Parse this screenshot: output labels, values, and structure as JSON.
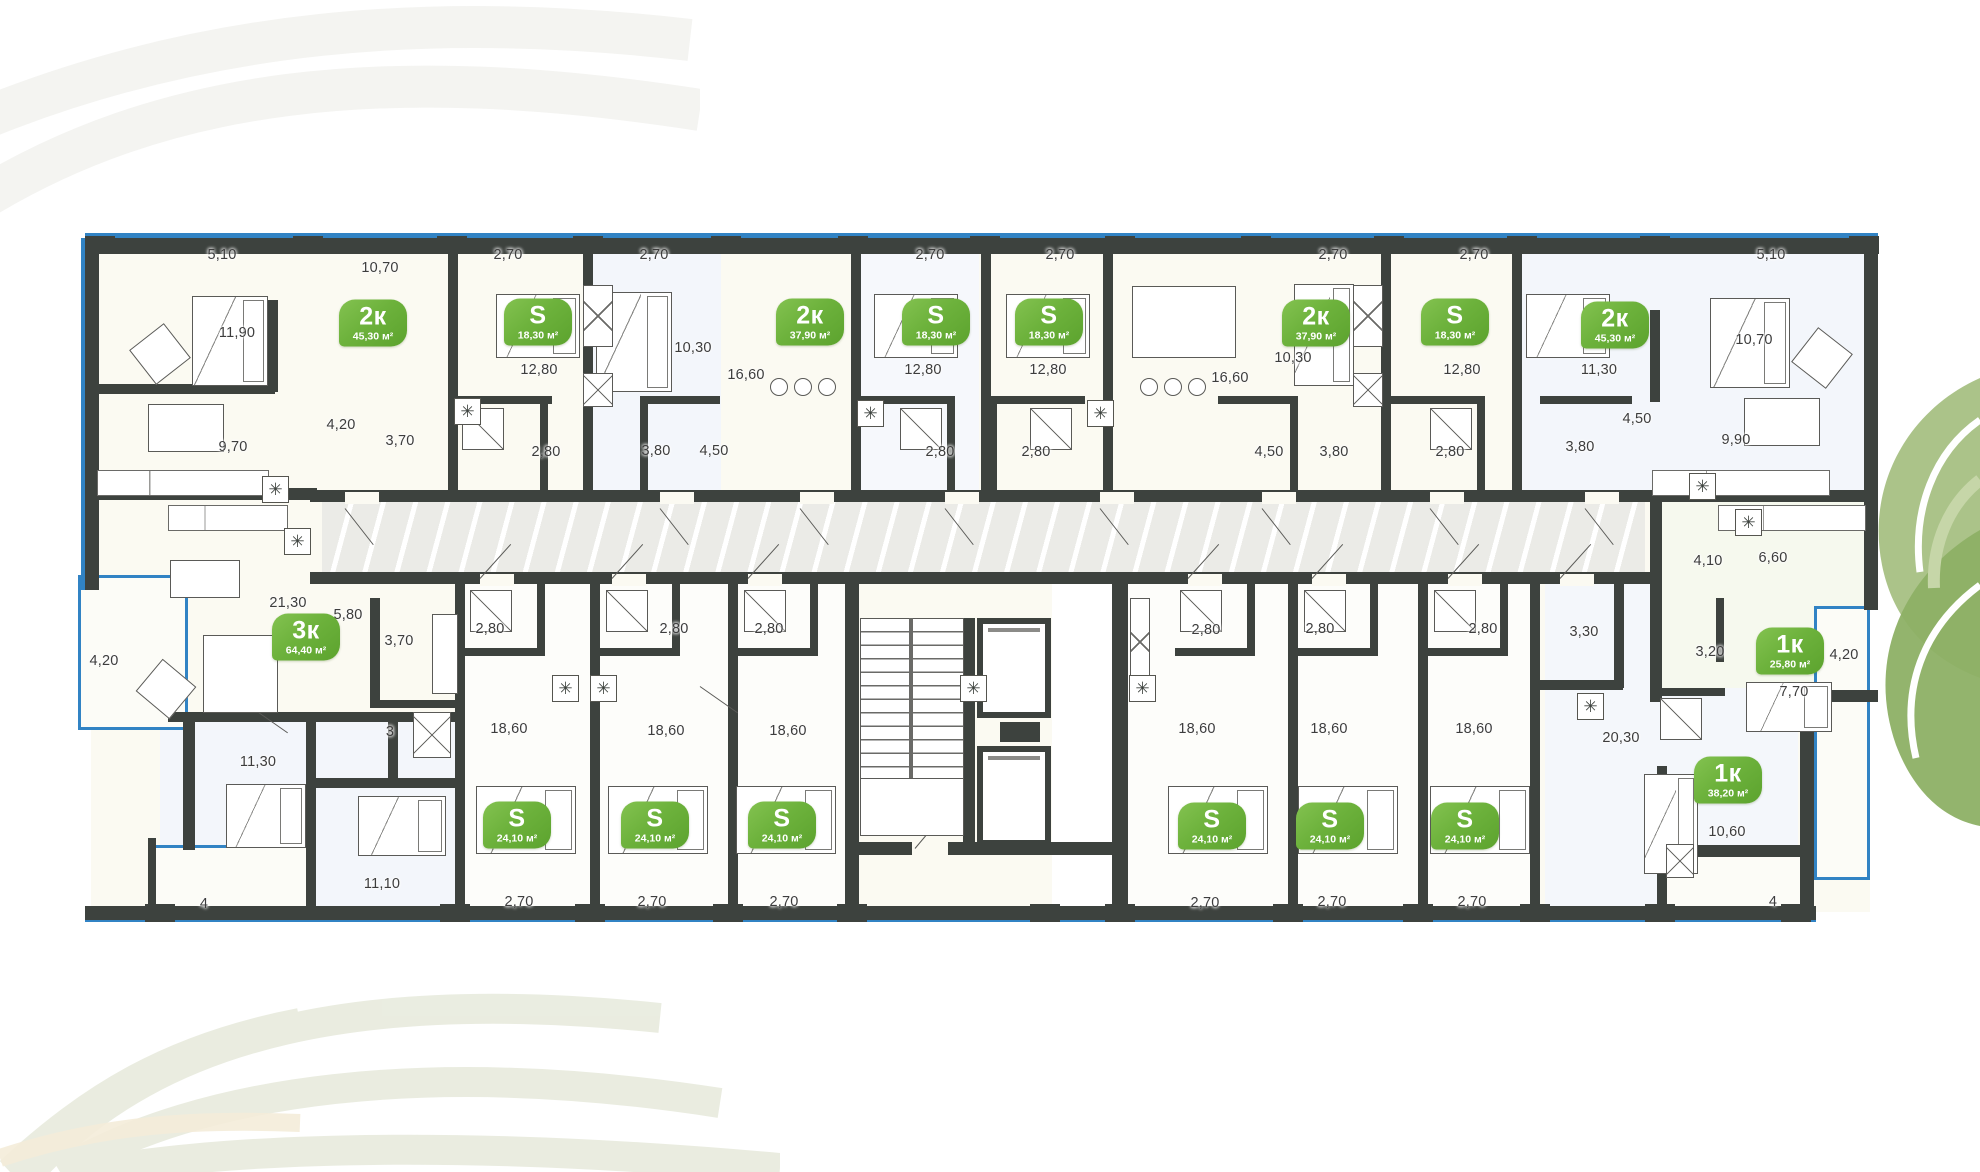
{
  "plan_meta": {
    "kind": "residential floor plan",
    "floor_badge_unit_types": [
      "1к",
      "2к",
      "3к",
      "S"
    ]
  },
  "palette": {
    "wall": "#3d423e",
    "window_blue": "#3183c4",
    "badge_green": "#6db23c",
    "badge_green_light": "#83c250",
    "badge_green_dark": "#5ca32e",
    "dim_text": "#3d3d3d",
    "corridor_fill": "#ebebe7"
  },
  "icons": {
    "appliance_icon_glyph": "✳"
  },
  "apartments": [
    {
      "type": "2к",
      "area": "45,30 м²",
      "x": 373,
      "y": 323
    },
    {
      "type": "S",
      "area": "18,30 м²",
      "x": 538,
      "y": 322
    },
    {
      "type": "2к",
      "area": "37,90 м²",
      "x": 810,
      "y": 322
    },
    {
      "type": "S",
      "area": "18,30 м²",
      "x": 936,
      "y": 322
    },
    {
      "type": "S",
      "area": "18,30 м²",
      "x": 1049,
      "y": 322
    },
    {
      "type": "2к",
      "area": "37,90 м²",
      "x": 1316,
      "y": 323
    },
    {
      "type": "S",
      "area": "18,30 м²",
      "x": 1455,
      "y": 322
    },
    {
      "type": "2к",
      "area": "45,30 м²",
      "x": 1615,
      "y": 325
    },
    {
      "type": "3к",
      "area": "64,40 м²",
      "x": 306,
      "y": 637
    },
    {
      "type": "S",
      "area": "24,10 м²",
      "x": 517,
      "y": 825
    },
    {
      "type": "S",
      "area": "24,10 м²",
      "x": 655,
      "y": 825
    },
    {
      "type": "S",
      "area": "24,10 м²",
      "x": 782,
      "y": 825
    },
    {
      "type": "S",
      "area": "24,10 м²",
      "x": 1212,
      "y": 826
    },
    {
      "type": "S",
      "area": "24,10 м²",
      "x": 1330,
      "y": 826
    },
    {
      "type": "S",
      "area": "24,10 м²",
      "x": 1465,
      "y": 826
    },
    {
      "type": "1к",
      "area": "25,80 м²",
      "x": 1790,
      "y": 651
    },
    {
      "type": "1к",
      "area": "38,20 м²",
      "x": 1728,
      "y": 780
    }
  ],
  "dimensions": [
    {
      "t": "5,10",
      "x": 222,
      "y": 255
    },
    {
      "t": "10,70",
      "x": 380,
      "y": 268
    },
    {
      "t": "11,90",
      "x": 237,
      "y": 333
    },
    {
      "t": "4,20",
      "x": 341,
      "y": 425
    },
    {
      "t": "3,70",
      "x": 400,
      "y": 441
    },
    {
      "t": "9,70",
      "x": 233,
      "y": 447
    },
    {
      "t": "2,70",
      "x": 508,
      "y": 255
    },
    {
      "t": "12,80",
      "x": 539,
      "y": 370
    },
    {
      "t": "2,80",
      "x": 546,
      "y": 452
    },
    {
      "t": "2,70",
      "x": 654,
      "y": 255
    },
    {
      "t": "10,30",
      "x": 693,
      "y": 348
    },
    {
      "t": "3,80",
      "x": 656,
      "y": 451
    },
    {
      "t": "4,50",
      "x": 714,
      "y": 451
    },
    {
      "t": "16,60",
      "x": 746,
      "y": 375
    },
    {
      "t": "2,70",
      "x": 930,
      "y": 255
    },
    {
      "t": "12,80",
      "x": 923,
      "y": 370
    },
    {
      "t": "2,80",
      "x": 940,
      "y": 452
    },
    {
      "t": "2,70",
      "x": 1060,
      "y": 255
    },
    {
      "t": "12,80",
      "x": 1048,
      "y": 370
    },
    {
      "t": "2,80",
      "x": 1036,
      "y": 452
    },
    {
      "t": "16,60",
      "x": 1230,
      "y": 378
    },
    {
      "t": "10,30",
      "x": 1293,
      "y": 358
    },
    {
      "t": "2,70",
      "x": 1333,
      "y": 255
    },
    {
      "t": "4,50",
      "x": 1269,
      "y": 452
    },
    {
      "t": "3,80",
      "x": 1334,
      "y": 452
    },
    {
      "t": "2,70",
      "x": 1474,
      "y": 255
    },
    {
      "t": "12,80",
      "x": 1462,
      "y": 370
    },
    {
      "t": "2,80",
      "x": 1450,
      "y": 452
    },
    {
      "t": "11,30",
      "x": 1599,
      "y": 370
    },
    {
      "t": "3,80",
      "x": 1580,
      "y": 447
    },
    {
      "t": "5,10",
      "x": 1771,
      "y": 255
    },
    {
      "t": "10,70",
      "x": 1754,
      "y": 340
    },
    {
      "t": "4,50",
      "x": 1637,
      "y": 419
    },
    {
      "t": "9,90",
      "x": 1736,
      "y": 440
    },
    {
      "t": "21,30",
      "x": 288,
      "y": 603
    },
    {
      "t": "5,80",
      "x": 348,
      "y": 615
    },
    {
      "t": "4,20",
      "x": 104,
      "y": 661
    },
    {
      "t": "3,70",
      "x": 399,
      "y": 641
    },
    {
      "t": "11,30",
      "x": 258,
      "y": 762
    },
    {
      "t": "3",
      "x": 390,
      "y": 732
    },
    {
      "t": "11,10",
      "x": 382,
      "y": 884
    },
    {
      "t": "4",
      "x": 204,
      "y": 904
    },
    {
      "t": "2,80",
      "x": 490,
      "y": 629
    },
    {
      "t": "2,80",
      "x": 674,
      "y": 629
    },
    {
      "t": "2,80",
      "x": 769,
      "y": 629
    },
    {
      "t": "18,60",
      "x": 509,
      "y": 729
    },
    {
      "t": "18,60",
      "x": 666,
      "y": 731
    },
    {
      "t": "18,60",
      "x": 788,
      "y": 731
    },
    {
      "t": "2,70",
      "x": 519,
      "y": 902
    },
    {
      "t": "2,70",
      "x": 652,
      "y": 902
    },
    {
      "t": "2,70",
      "x": 784,
      "y": 902
    },
    {
      "t": "2,80",
      "x": 1206,
      "y": 630
    },
    {
      "t": "2,80",
      "x": 1320,
      "y": 629
    },
    {
      "t": "2,80",
      "x": 1483,
      "y": 629
    },
    {
      "t": "18,60",
      "x": 1197,
      "y": 729
    },
    {
      "t": "18,60",
      "x": 1329,
      "y": 729
    },
    {
      "t": "18,60",
      "x": 1474,
      "y": 729
    },
    {
      "t": "2,70",
      "x": 1205,
      "y": 903
    },
    {
      "t": "2,70",
      "x": 1332,
      "y": 902
    },
    {
      "t": "2,70",
      "x": 1472,
      "y": 902
    },
    {
      "t": "3,30",
      "x": 1584,
      "y": 632
    },
    {
      "t": "20,30",
      "x": 1621,
      "y": 738
    },
    {
      "t": "4,10",
      "x": 1708,
      "y": 561
    },
    {
      "t": "6,60",
      "x": 1773,
      "y": 558
    },
    {
      "t": "3,20",
      "x": 1710,
      "y": 652
    },
    {
      "t": "7,70",
      "x": 1794,
      "y": 692
    },
    {
      "t": "4,20",
      "x": 1844,
      "y": 655
    },
    {
      "t": "10,60",
      "x": 1727,
      "y": 832
    },
    {
      "t": "4",
      "x": 1773,
      "y": 902
    }
  ]
}
